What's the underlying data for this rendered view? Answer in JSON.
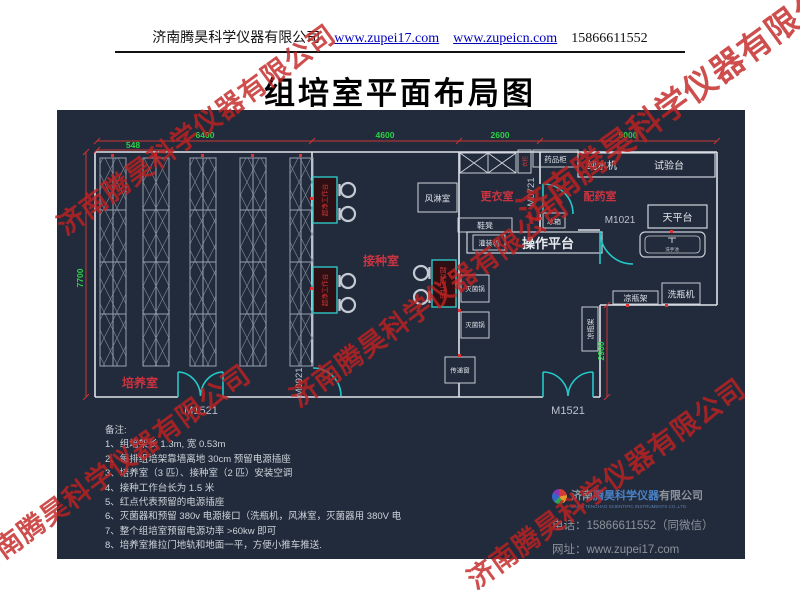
{
  "header": {
    "company": "济南腾昊科学仪器有限公司",
    "link1": "www.zupei17.com",
    "link2": "www.zupeicn.com",
    "phone": "15866611552"
  },
  "title": "组培室平面布局图",
  "watermark": {
    "text": "济南腾昊科学仪器有限公司",
    "color": "#c22222"
  },
  "plan": {
    "dims": {
      "d548": "548",
      "d6400": "6400",
      "d4600": "4600",
      "d2600": "2600",
      "d5000": "5000",
      "d7700": "7700",
      "d2900": "2900"
    },
    "rooms": {
      "culture": "培养室",
      "inoculation": "接种室",
      "changing": "更衣室",
      "dispensing": "配药室",
      "air_shower": "风淋室"
    },
    "doors": {
      "m0921": "M0921",
      "m0721": "M0721",
      "m1021": "M1021",
      "m1521": "M1521"
    },
    "equipment": {
      "clean_bench": "超净工作台",
      "medicine_cabinet": "药品柜",
      "wardrobe": "衣柜",
      "water_purifier": "纯水机",
      "test_bench": "试验台",
      "balance_table": "天平台",
      "operation_platform": "操作平台",
      "shoe_bench": "鞋凳",
      "fridge": "冰箱",
      "filling_machine": "灌装机",
      "sterilizer": "灭菌锅",
      "transfer_window": "传递窗",
      "bottle_rack": "凉瓶架",
      "bottle_washer": "洗瓶机",
      "hand_sink": "洗手池"
    },
    "colors": {
      "background": "#222b3b",
      "wall": "#dfe3ea",
      "dimension_line": "#cd3434",
      "dimension_text": "#2bd245",
      "door": "#25c8c8",
      "room_label": "#cb3340",
      "equipment_text": "#d5d9e0",
      "outlet_dot": "#e03232"
    }
  },
  "notes": {
    "title": "备注:",
    "items": [
      "1、组培架长 1.3m, 宽 0.53m",
      "2、每排组培架靠墙离地 30cm 预留电源插座",
      "3、培养室（3 匹）、接种室（2 匹）安装空调",
      "4、接种工作台长为 1.5 米",
      "5、红点代表预留的电源插座",
      "6、灭菌器和预留 380v 电源接口（洗瓶机，风淋室，灭菌器用 380V 电",
      "7、整个组培室预留电源功率 >60kw 即可",
      "8、培养室推拉门地轨和地面一平，方便小推车推送."
    ]
  },
  "footer": {
    "company_gray1": "济南",
    "company_blue": "腾昊科学仪器",
    "company_gray2": "有限公司",
    "company_en": "JINAN TENGHAO SCIENTIFIC INSTRUMENTS CO.,LTD.",
    "phone_label": "电话：",
    "phone": "15866611552（同微信）",
    "web_label": "网址：",
    "web": "www.zupei17.com"
  }
}
